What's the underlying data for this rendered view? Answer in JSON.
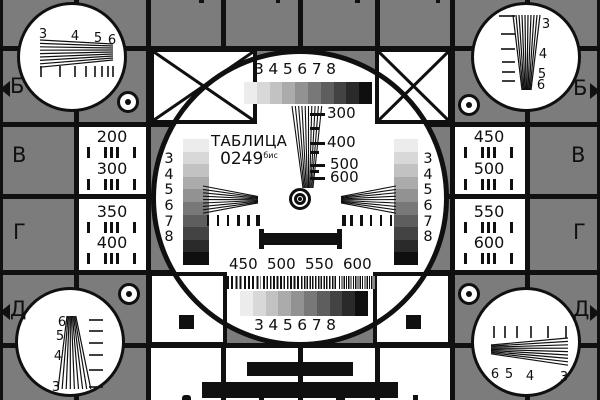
{
  "card": {
    "title": "ТАБЛИЦА",
    "number": "0249",
    "number_suffix": "бис",
    "row_labels_left": [
      "Б",
      "В",
      "Г",
      "Д"
    ],
    "row_labels_right": [
      "Б",
      "В",
      "Г",
      "Д"
    ],
    "resolution_digits": [
      "3",
      "4",
      "5",
      "6",
      "7",
      "8"
    ],
    "corner_digits": [
      "3",
      "4",
      "5",
      "6"
    ],
    "corner_digits_reversed": [
      "6",
      "5",
      "4",
      "3"
    ],
    "frequency_labels": [
      "300",
      "400",
      "500",
      "600"
    ],
    "burst_labels": [
      "450",
      "500",
      "550",
      "600"
    ],
    "left_frequency_column": [
      "200",
      "300",
      "350",
      "400"
    ],
    "right_frequency_column": [
      "450",
      "500",
      "550",
      "600"
    ],
    "colors": {
      "background": "#7c7c7c",
      "ink": "#101010",
      "paper": "#ffffff"
    },
    "grayscale_steps": [
      "#ececec",
      "#d8d8d8",
      "#c2c2c2",
      "#ababab",
      "#929292",
      "#787878",
      "#5e5e5e",
      "#434343",
      "#2a2a2a",
      "#0f0f0f"
    ]
  }
}
